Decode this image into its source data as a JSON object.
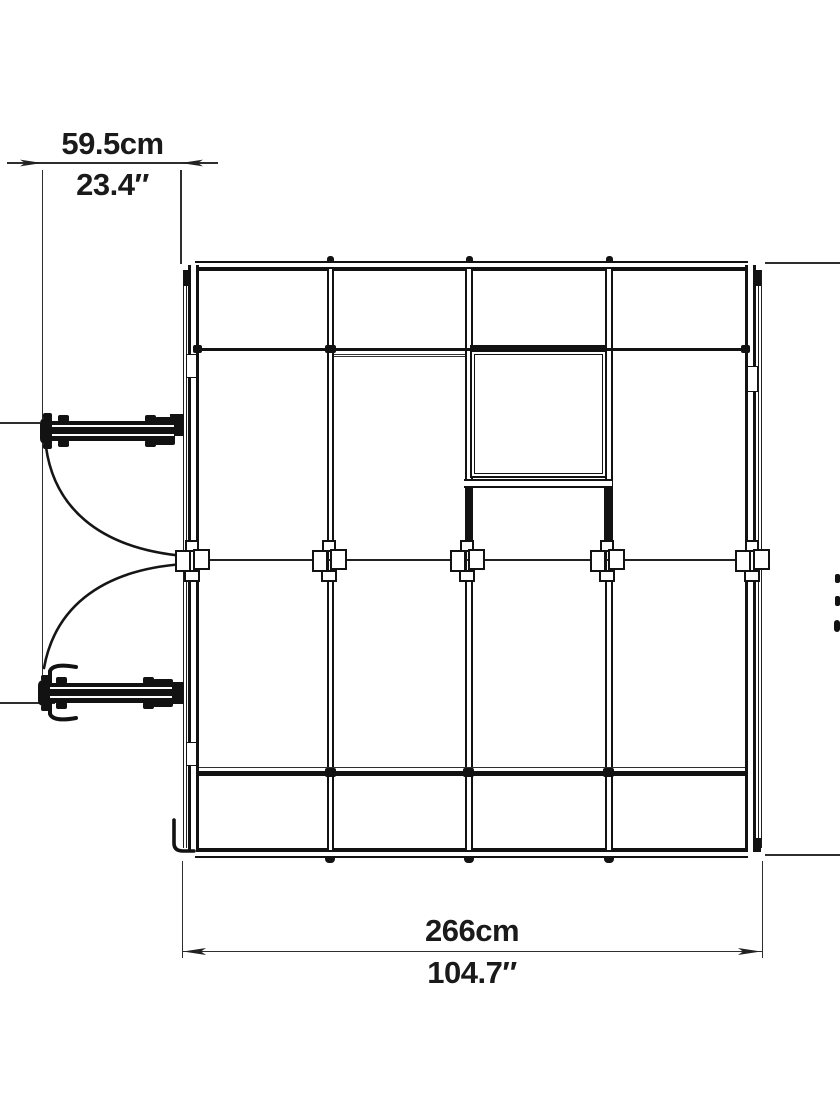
{
  "page": {
    "background": "#ffffff",
    "line_color": "#121212"
  },
  "drawing": {
    "type": "technical-dimension-drawing",
    "view": "top view of greenhouse frame with double swing doors and roof vent",
    "dimensions": {
      "door": {
        "metric": "59.5cm",
        "imperial": "23.4″"
      },
      "width": {
        "metric": "266cm",
        "imperial": "104.7″"
      }
    },
    "annotations": {
      "arrow_style": "filled slender triangles",
      "right_dimension_text": "clipped at image edge (illegible fragments)"
    }
  }
}
